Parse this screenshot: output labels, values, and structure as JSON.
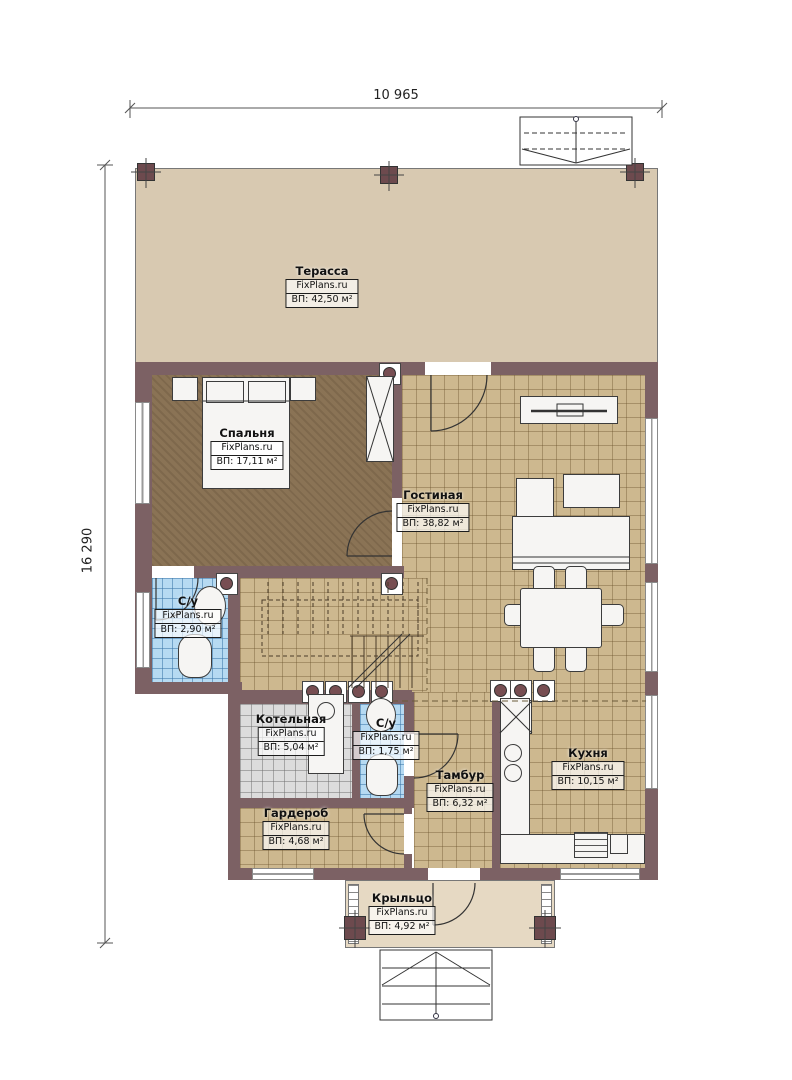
{
  "type": "floor-plan",
  "watermark": "FixPlans.ru",
  "dimensions": {
    "width": "10 965",
    "height": "16 290"
  },
  "rooms": [
    {
      "key": "terrace",
      "name": "Терасса",
      "provider": "FixPlans.ru",
      "area": "ВП: 42,50 м²"
    },
    {
      "key": "bedroom",
      "name": "Спальня",
      "provider": "FixPlans.ru",
      "area": "ВП: 17,11 м²"
    },
    {
      "key": "living",
      "name": "Гостиная",
      "provider": "FixPlans.ru",
      "area": "ВП: 38,82 м²"
    },
    {
      "key": "wc-1",
      "name": "С/у",
      "provider": "FixPlans.ru",
      "area": "ВП: 2,90 м²"
    },
    {
      "key": "boiler",
      "name": "Котельная",
      "provider": "FixPlans.ru",
      "area": "ВП: 5,04 м²"
    },
    {
      "key": "wc-2",
      "name": "С/у",
      "provider": "FixPlans.ru",
      "area": "ВП: 1,75 м²"
    },
    {
      "key": "tambour",
      "name": "Тамбур",
      "provider": "FixPlans.ru",
      "area": "ВП: 6,32 м²"
    },
    {
      "key": "kitchen",
      "name": "Кухня",
      "provider": "FixPlans.ru",
      "area": "ВП: 10,15 м²"
    },
    {
      "key": "wardrobe",
      "name": "Гардероб",
      "provider": "FixPlans.ru",
      "area": "ВП: 4,68 м²"
    },
    {
      "key": "porch",
      "name": "Крыльцо",
      "provider": "FixPlans.ru",
      "area": "ВП: 4,92 м²"
    }
  ],
  "colors": {
    "wall": "#7c6164",
    "tile_floor": "#cdb88f",
    "bedroom_floor": "#8a7355",
    "wet_room_tile": "#b6daf2",
    "boiler_tile": "#dcdcdc",
    "terrace_floor": "#d8c9b1",
    "porch_floor": "#e6d9c3"
  }
}
